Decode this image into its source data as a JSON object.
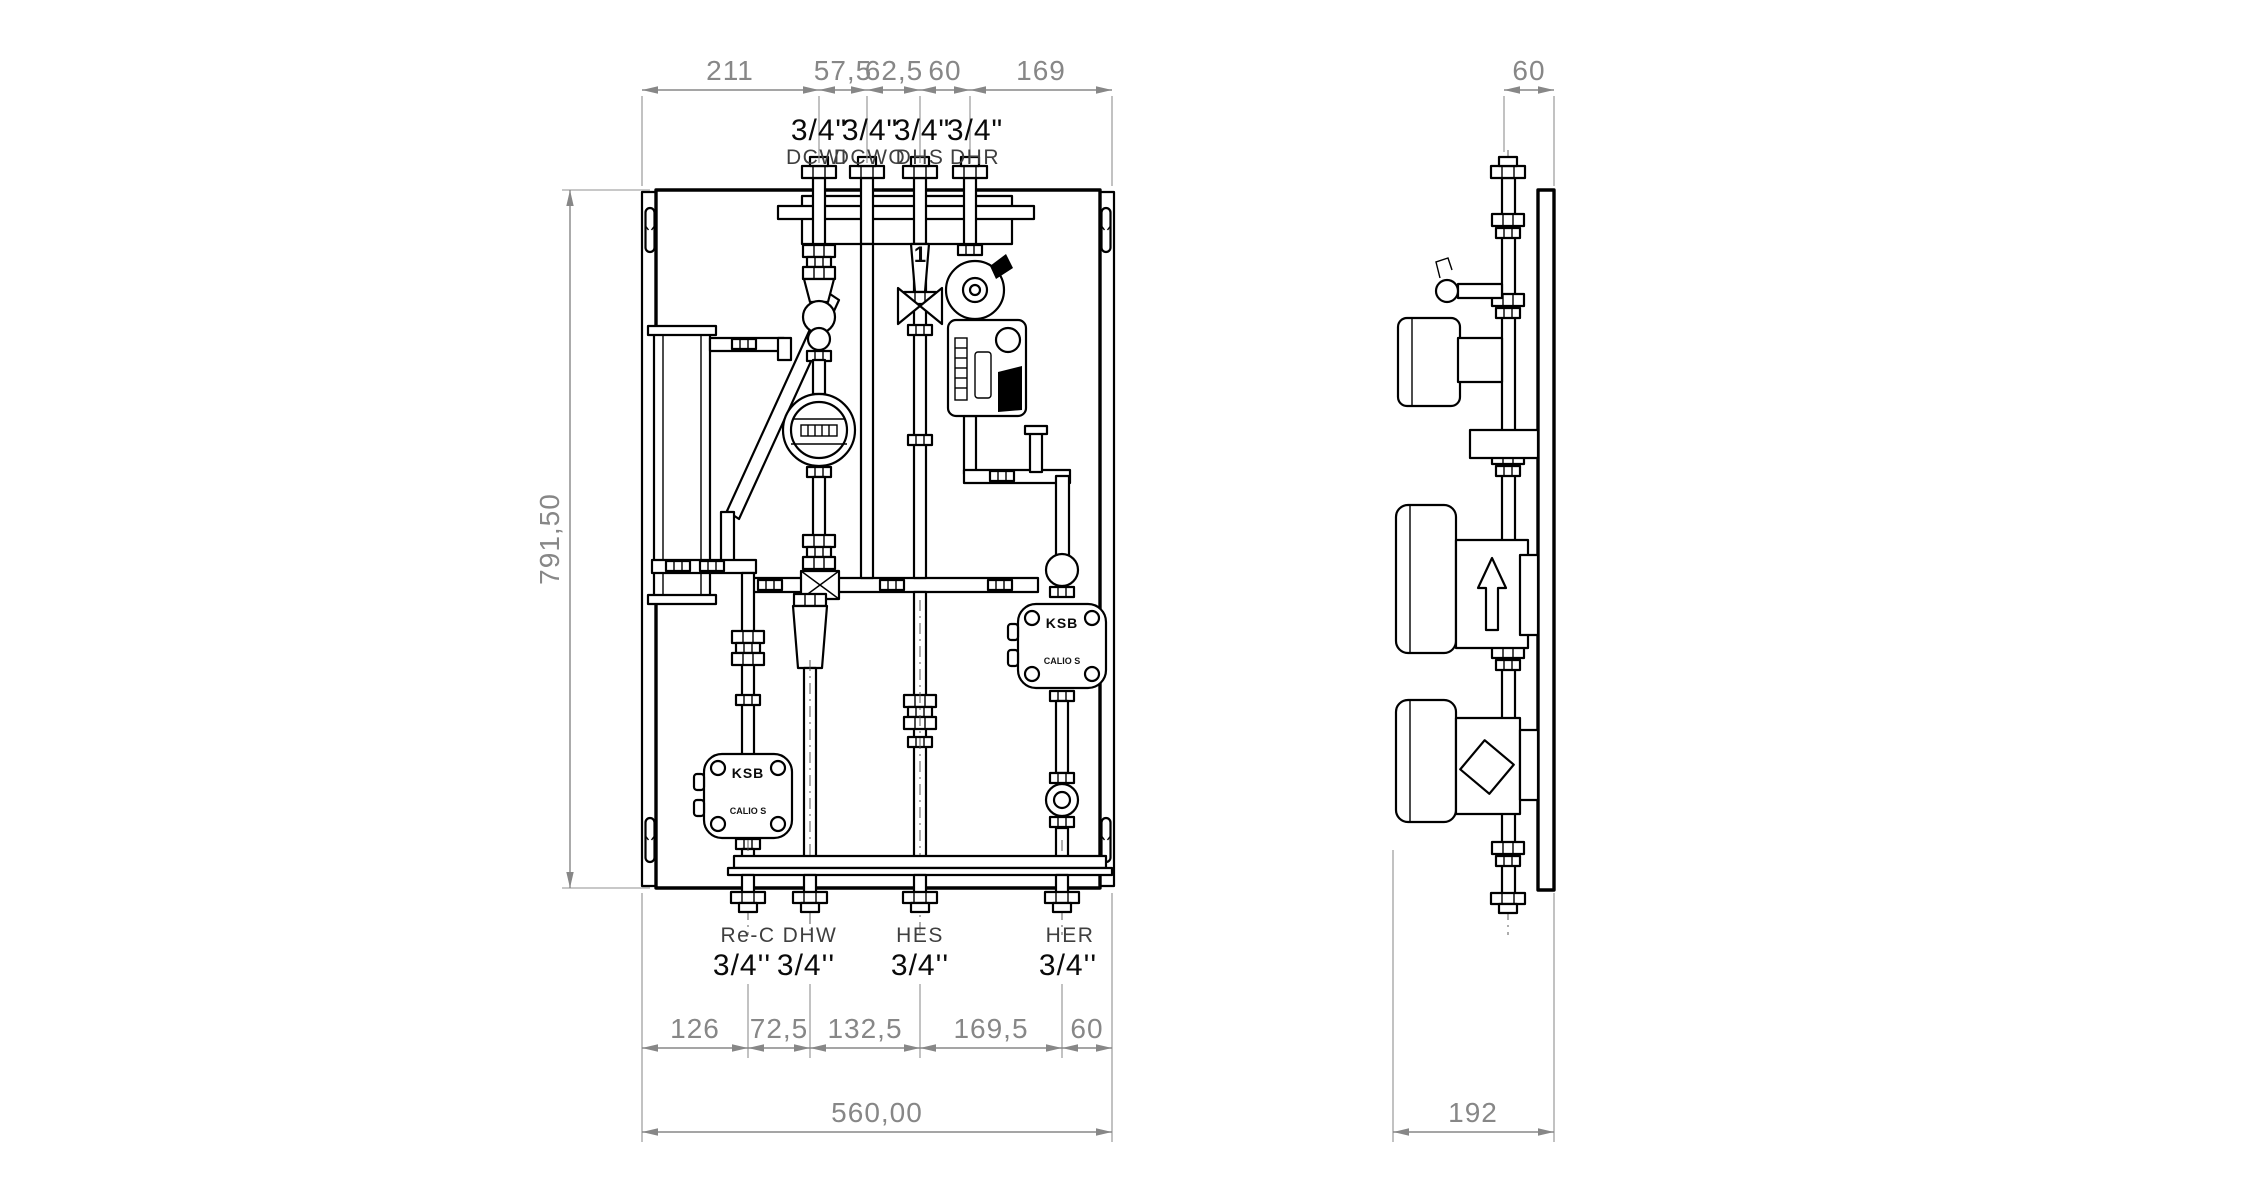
{
  "drawing": {
    "type": "technical-dimension-drawing",
    "background": "#ffffff",
    "line_color": "#000000",
    "dimension_color": "#878787"
  },
  "front": {
    "height_dim": "791,50",
    "width_dim": "560,00",
    "top_dims": [
      "211",
      "57,5",
      "62,5",
      "60",
      "169"
    ],
    "bottom_dims": [
      "126",
      "72,5",
      "132,5",
      "169,5",
      "60"
    ],
    "top_ports": [
      {
        "size": "3/4\"",
        "name": "DCWI"
      },
      {
        "size": "3/4\"",
        "name": "DCWO"
      },
      {
        "size": "3/4\"",
        "name": "DHS"
      },
      {
        "size": "3/4\"",
        "name": "DHR"
      }
    ],
    "bottom_ports": [
      {
        "name": "Re-C",
        "size": "3/4''"
      },
      {
        "name": "DHW",
        "size": "3/4''"
      },
      {
        "name": "HES",
        "size": "3/4''"
      },
      {
        "name": "HER",
        "size": "3/4''"
      }
    ],
    "valve_handle_label": "1",
    "pump_brand": "KSB",
    "pump_model": "CALIO S"
  },
  "side": {
    "offset_dim": "60",
    "depth_dim": "192"
  }
}
